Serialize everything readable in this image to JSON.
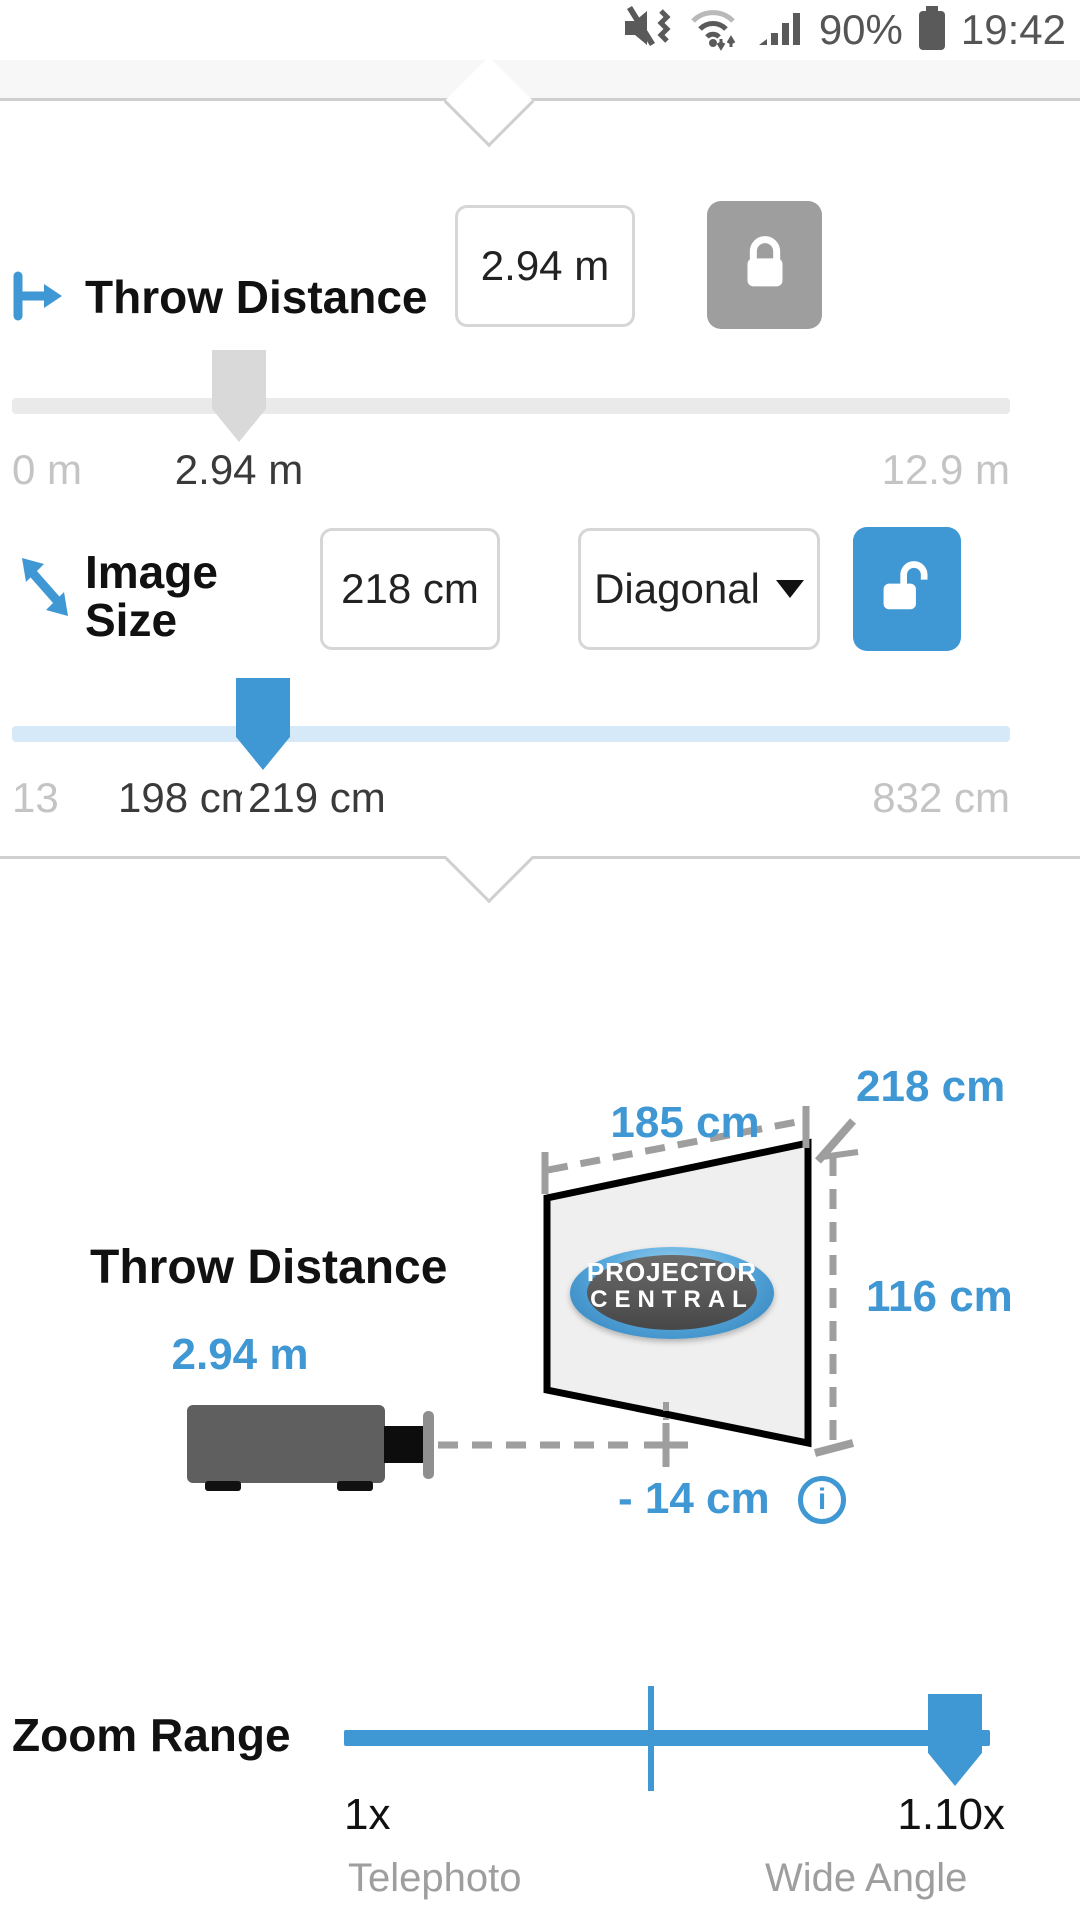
{
  "colors": {
    "accent": "#3f97d3",
    "locked_gray": "#9e9e9e"
  },
  "status_bar": {
    "battery_percent": "90%",
    "time": "19:42"
  },
  "panel": {
    "throw_distance": {
      "label": "Throw Distance",
      "value": "2.94 m",
      "slider": {
        "min_label": "0 m",
        "value_label": "2.94 m",
        "max_label": "12.9 m"
      }
    },
    "image_size": {
      "label_line1": "Image",
      "label_line2": "Size",
      "value": "218 cm",
      "dimension": "Diagonal",
      "slider": {
        "min_label": "13",
        "tele_label": "198 cm",
        "value_label": "219 cm",
        "max_label": "832 cm"
      }
    }
  },
  "diagram": {
    "width_label": "185 cm",
    "diagonal_label": "218 cm",
    "height_label": "116 cm",
    "throw_label": "Throw Distance",
    "throw_value": "2.94 m",
    "offset_label": "- 14 cm",
    "info_glyph": "i",
    "logo_line1": "PROJECTOR",
    "logo_line2": "CENTRAL"
  },
  "zoom_range": {
    "label": "Zoom Range",
    "min_value": "1x",
    "min_caption": "Telephoto",
    "max_value": "1.10x",
    "max_caption": "Wide Angle"
  }
}
